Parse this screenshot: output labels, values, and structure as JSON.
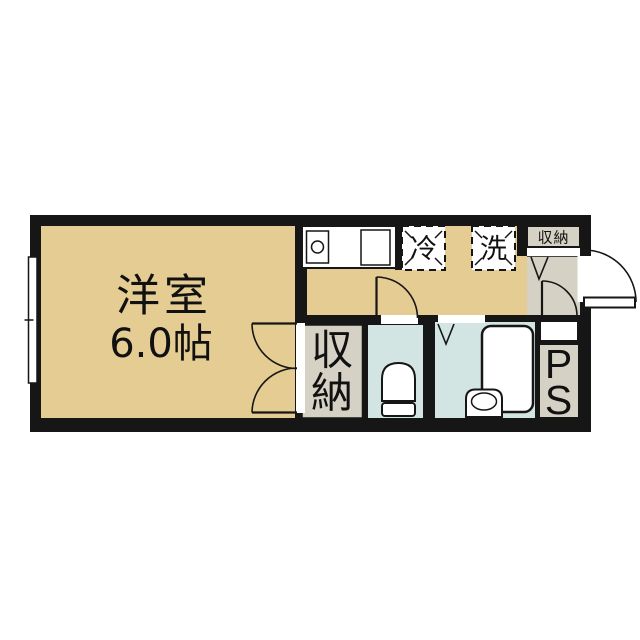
{
  "floorplan": {
    "rooms": {
      "main_room": {
        "label": "洋室",
        "size": "6.0帖"
      },
      "fridge_space": {
        "label": "冷"
      },
      "washer_space": {
        "label": "洗"
      },
      "entrance_storage": {
        "label": "収納"
      },
      "closet": {
        "char1": "収",
        "char2": "納"
      },
      "pipe_space": {
        "char1": "P",
        "char2": "S"
      }
    },
    "colors": {
      "wall_black": "#161616",
      "room_tan": "#e5cc93",
      "wet_area_blue": "#d3e5e2",
      "entry_gray": "#d5d1c4",
      "fixture_white": "#ffffff"
    }
  }
}
